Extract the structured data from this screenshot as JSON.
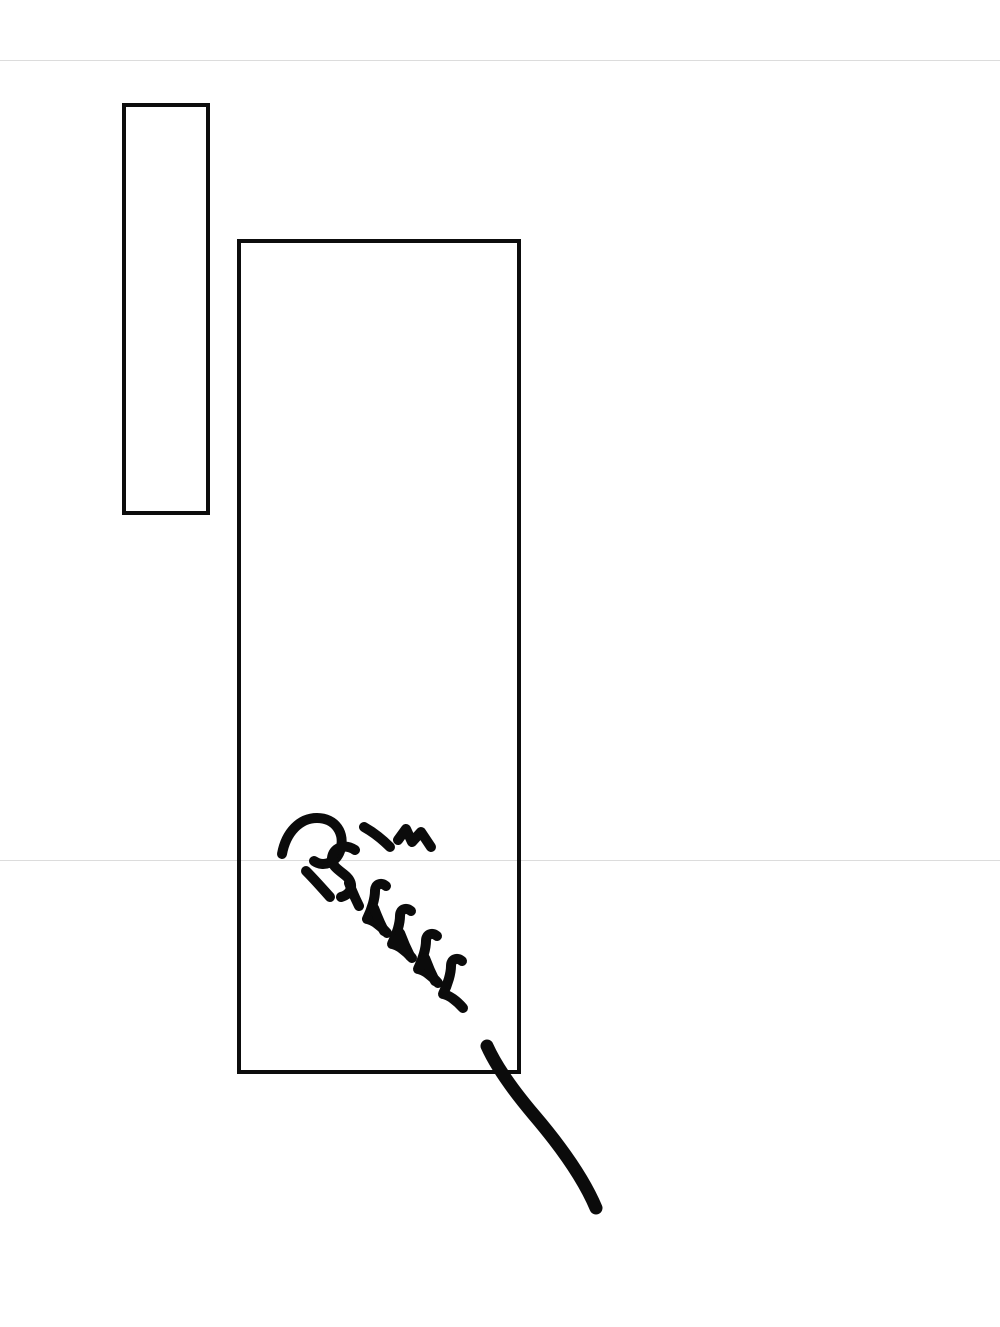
{
  "page": {
    "background": "#ffffff",
    "ink_color": "#0b0b0b",
    "seam_color": "#dcdcdc"
  },
  "sfx": {
    "text": "กรี๊งงงง",
    "strokes": [
      "M282 854 C286 832 300 818 317 818 C335 818 346 833 340 851 C336 862 324 868 314 861",
      "M306 871 C314 879 322 888 330 897",
      "M355 850 C344 843 333 848 332 858 C331 867 341 871 347 877 C354 884 352 894 341 897",
      "M364 827 C373 832 382 839 390 847",
      "M398 840 L406 829 L412 842 L421 832 L431 847",
      "M349 883 C352 891 355 898 359 906",
      "M386 886 C381 882 375 884 375 891 C375 898 372 909 367 919 C373 920 381 926 387 933",
      "M374 908 C377 916 380 923 384 931",
      "M411 911 C406 907 400 909 400 916 C400 923 397 934 392 944 C398 945 406 951 412 958",
      "M400 933 C403 941 406 948 410 956",
      "M437 936 C432 932 426 934 426 941 C426 948 423 959 418 969 C424 970 432 976 438 983",
      "M425 958 C428 966 431 973 435 981",
      "M462 961 C457 957 451 959 451 966 C451 973 448 984 443 994 C449 995 457 1001 463 1008"
    ],
    "tail_stroke": "M487 1046 C496 1066 512 1089 534 1115 C557 1142 583 1177 596 1208"
  }
}
